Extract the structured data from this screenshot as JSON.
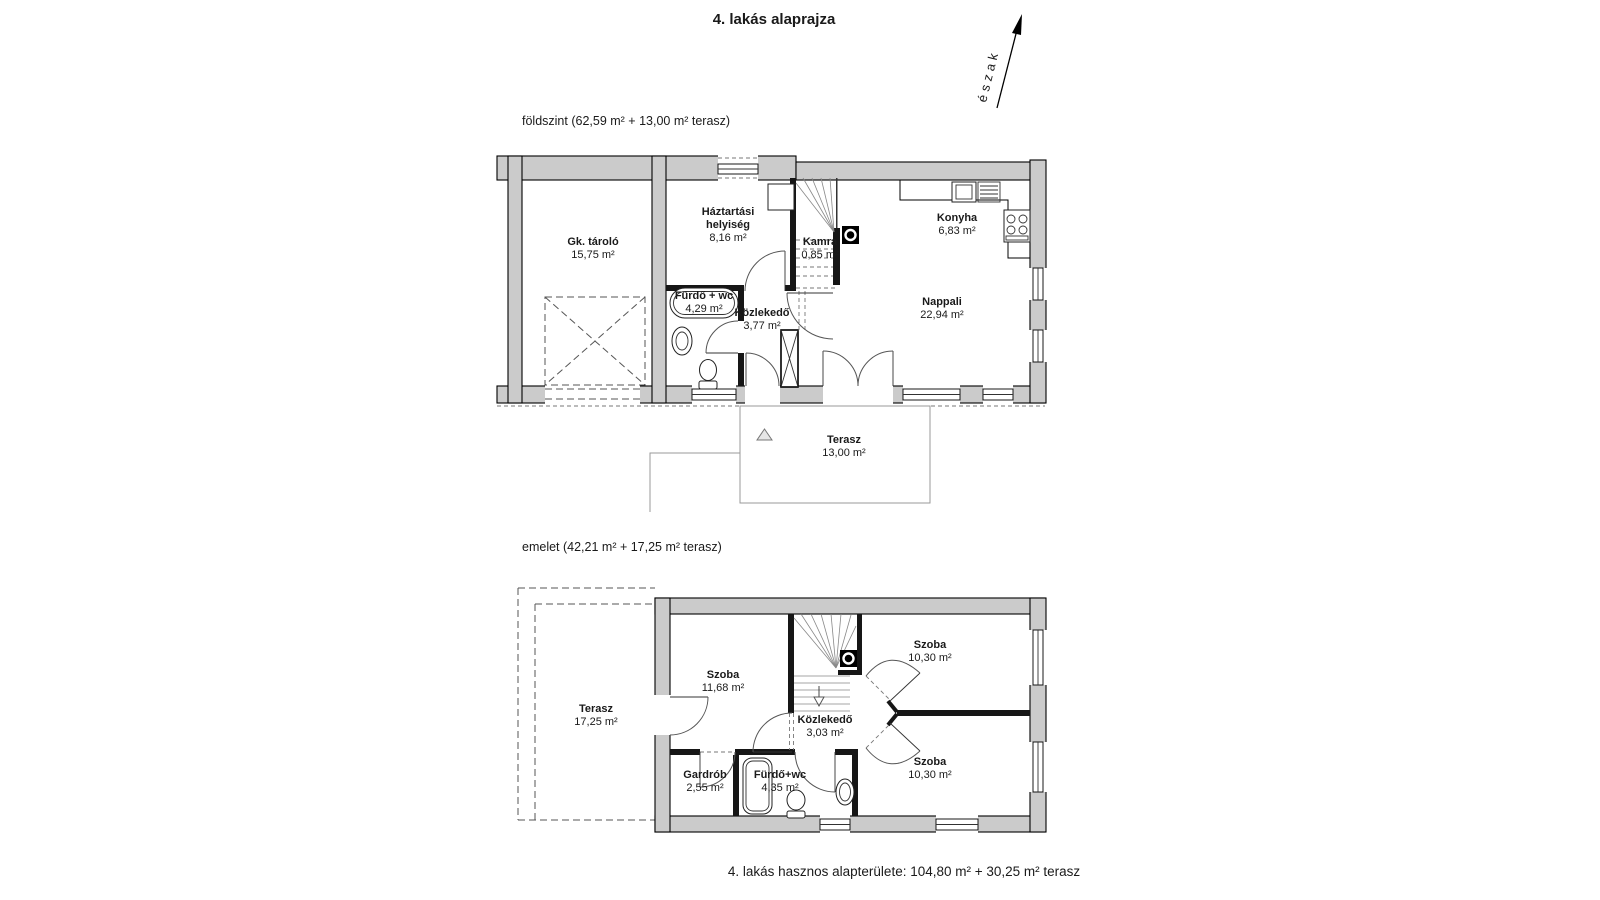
{
  "title": "4. lakás alaprajza",
  "compass": {
    "label": "észak"
  },
  "ground_floor": {
    "heading": "földszint (62,59 m² + 13,00 m² terasz)",
    "rooms": {
      "gk_tarolo": {
        "name": "Gk. tároló",
        "area": "15,75 m²"
      },
      "haztartasi": {
        "name": "Háztartási helyiség",
        "area": "8,16 m²"
      },
      "kamra": {
        "name": "Kamra",
        "area": "0,85 m²"
      },
      "konyha": {
        "name": "Konyha",
        "area": "6,83 m²"
      },
      "furdo": {
        "name": "Fürdő + wc",
        "area": "4,29 m²"
      },
      "kozlekedo": {
        "name": "Közlekedő",
        "area": "3,77 m²"
      },
      "nappali": {
        "name": "Nappali",
        "area": "22,94 m²"
      },
      "terasz": {
        "name": "Terasz",
        "area": "13,00 m²"
      }
    }
  },
  "upper_floor": {
    "heading": "emelet (42,21 m² + 17,25 m² terasz)",
    "rooms": {
      "terasz": {
        "name": "Terasz",
        "area": "17,25 m²"
      },
      "szoba_nagy": {
        "name": "Szoba",
        "area": "11,68 m²"
      },
      "szoba_felso": {
        "name": "Szoba",
        "area": "10,30 m²"
      },
      "kozlekedo": {
        "name": "Közlekedő",
        "area": "3,03 m²"
      },
      "szoba_also": {
        "name": "Szoba",
        "area": "10,30 m²"
      },
      "gardrob": {
        "name": "Gardrób",
        "area": "2,55 m²"
      },
      "furdo": {
        "name": "Fürdő+wc",
        "area": "4,35 m²"
      }
    }
  },
  "footer": "4. lakás hasznos alapterülete: 104,80 m² + 30,25 m² terasz",
  "colors": {
    "wall_fill": "#cbcbcb",
    "line": "#000000",
    "background": "#ffffff"
  }
}
